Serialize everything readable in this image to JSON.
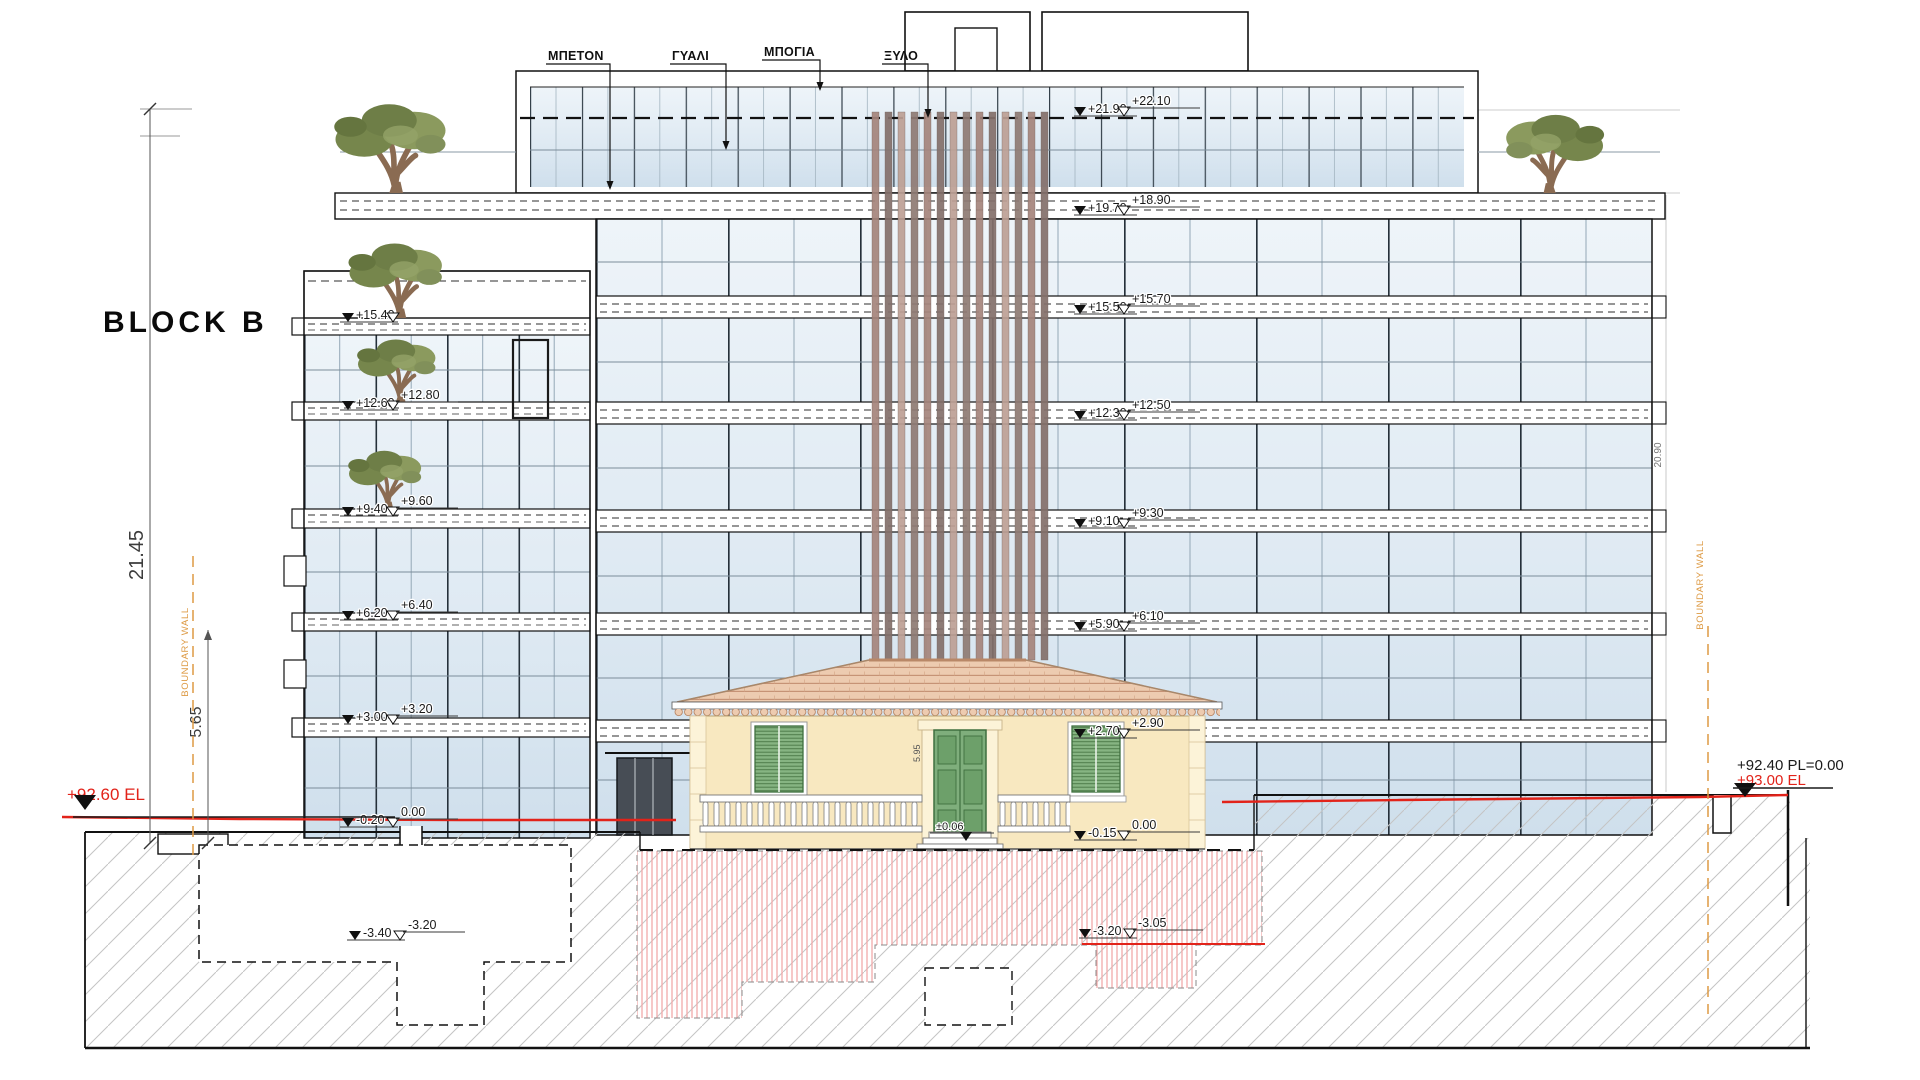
{
  "title": "BLOCK B",
  "material_labels": {
    "concrete": "ΜΠΕΤΟΝ",
    "glass": "ΓΥΑΛΙ",
    "paint": "ΜΠΟΓΙΑ",
    "wood": "ΞΥΛΟ"
  },
  "dimensions": {
    "left_total": "21.45",
    "left_lower": "5.65",
    "right_total": "20.90",
    "house_front": "5.95"
  },
  "boundary": {
    "left": "BOUNDARY WALL",
    "right": "BOUNDARY WALL"
  },
  "site_levels": {
    "left_existing": "+92.60 EL",
    "right_proposed": "+92.40 PL=0.00",
    "right_existing": "+93.00 EL"
  },
  "levels": {
    "right": [
      {
        "a": "+21.90",
        "b": "+22.10"
      },
      {
        "a": "+19.70",
        "b": "+18.90"
      },
      {
        "a": "+15.50",
        "b": "+15.70"
      },
      {
        "a": "+12.30",
        "b": "+12.50"
      },
      {
        "a": "+9.10",
        "b": "+9.30"
      },
      {
        "a": "+5.90",
        "b": "+6.10"
      },
      {
        "a": "+2.70",
        "b": "+2.90"
      },
      {
        "a": "-0.15",
        "b": "0.00"
      }
    ],
    "left": [
      {
        "a": "+15.40",
        "b": ""
      },
      {
        "a": "+12.60",
        "b": "+12.80"
      },
      {
        "a": "+9.40",
        "b": "+9.60"
      },
      {
        "a": "+6.20",
        "b": "+6.40"
      },
      {
        "a": "+3.00",
        "b": "+3.20"
      },
      {
        "a": "-0.20",
        "b": "0.00"
      }
    ],
    "basement_left": {
      "a": "-3.40",
      "b": "-3.20"
    },
    "basement_right": {
      "a": "-3.20",
      "b": "-3.05"
    },
    "house_entry": "±0.06"
  },
  "colors": {
    "level_line_red": "#e2231a",
    "boundary_orange": "#dd9a44",
    "house_wall_yellow": "#f8e8c0",
    "shutter_green": "#86b482",
    "roof_tile": "#edcbb0",
    "louver_wood": "#a5857c",
    "glass_tint": "#d4e2ee"
  }
}
